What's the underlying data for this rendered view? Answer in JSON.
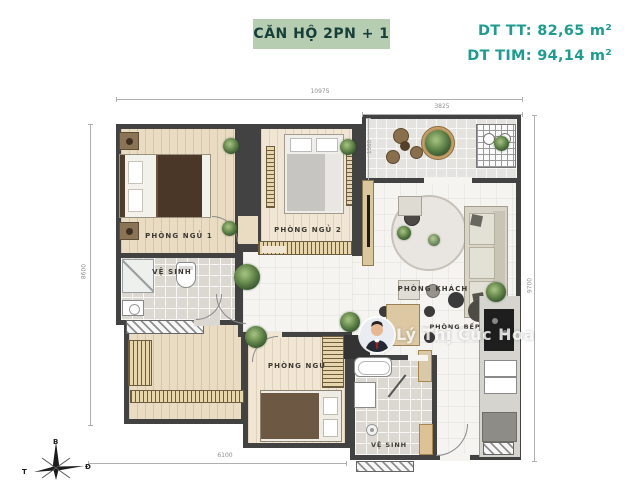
{
  "header": {
    "title": "CĂN HỘ 2PN + 1",
    "area_tt": "DT TT: 82,65 m²",
    "area_tim": "DT TIM: 94,14 m²"
  },
  "rooms": {
    "bedroom1": "PHÒNG NGỦ 1",
    "bedroom2": "PHÒNG NGỦ 2",
    "bathroom1": "VỆ SINH",
    "living_room": "PHÒNG KHÁCH",
    "kitchen": "PHÒNG BẾP",
    "bedroom3": "PHÒNG NGỦ",
    "bathroom2": "VỆ SINH"
  },
  "dimensions": {
    "total_width": "10975",
    "balcony_width": "3825",
    "balcony_depth": "1500",
    "left_height": "8600",
    "right_height": "9700",
    "bottom_width": "6100"
  },
  "compass": {
    "north": "B",
    "east": "Đ",
    "west": "T"
  },
  "watermark": "Lý Thị Cúc Hoa",
  "colors": {
    "accent_teal": "#1d9d8f",
    "title_bg": "#b7cdb1",
    "title_text": "#163f3a",
    "wall": "#424242"
  }
}
